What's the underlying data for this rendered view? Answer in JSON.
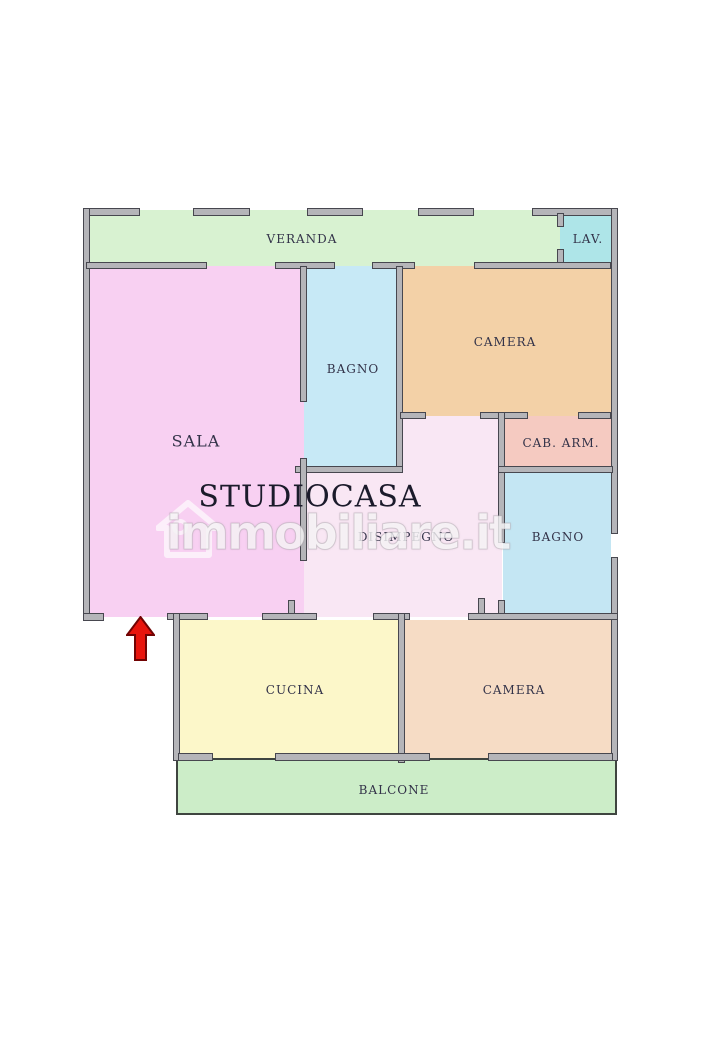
{
  "meta": {
    "width": 717,
    "height": 1050,
    "background": "#ffffff"
  },
  "palette": {
    "wall_fill": "#b5b5b9",
    "wall_border": "#47474f",
    "label_color": "#333349"
  },
  "brand_title": "STUDIOCASA",
  "watermark": {
    "text": "immobiliare.it",
    "icon": "house-icon"
  },
  "entrance_arrow": {
    "direction": "up",
    "fill": "#e8150d",
    "stroke": "#710303"
  },
  "rooms": [
    {
      "id": "veranda",
      "label": "VERANDA",
      "color": "#d8f2d1",
      "rect": [
        86,
        210,
        527,
        56
      ],
      "label_at": [
        302,
        239
      ],
      "font": 12
    },
    {
      "id": "lav",
      "label": "LAV.",
      "color": "#aee5e8",
      "rect": [
        560,
        210,
        53,
        56
      ],
      "label_at": [
        588,
        239
      ],
      "font": 12
    },
    {
      "id": "sala",
      "label": "SALA",
      "color": "#f8d0f2",
      "rect": [
        86,
        266,
        218,
        351
      ],
      "label_at": [
        196,
        441
      ],
      "font": 16
    },
    {
      "id": "disimpegno",
      "label": "DISIMPEGNO",
      "color": "#f9e7f4",
      "rect": [
        304,
        416,
        198,
        201
      ],
      "label_at": [
        406,
        537
      ],
      "font": 12
    },
    {
      "id": "bagno-1",
      "label": "BAGNO",
      "color": "#c7e9f6",
      "rect": [
        304,
        266,
        96,
        207
      ],
      "label_at": [
        353,
        369
      ],
      "font": 12
    },
    {
      "id": "camera-1",
      "label": "CAMERA",
      "color": "#f3d1a7",
      "rect": [
        400,
        266,
        213,
        150
      ],
      "label_at": [
        505,
        342
      ],
      "font": 12
    },
    {
      "id": "cab-arm",
      "label": "CAB. ARM.",
      "color": "#f5cac1",
      "rect": [
        503,
        416,
        110,
        57
      ],
      "label_at": [
        561,
        443
      ],
      "font": 12
    },
    {
      "id": "bagno-2",
      "label": "BAGNO",
      "color": "#c4e6f3",
      "rect": [
        503,
        473,
        108,
        144
      ],
      "label_at": [
        558,
        537
      ],
      "font": 12
    },
    {
      "id": "cucina",
      "label": "CUCINA",
      "color": "#fcf7c9",
      "rect": [
        178,
        620,
        222,
        140
      ],
      "label_at": [
        295,
        690
      ],
      "font": 12
    },
    {
      "id": "camera-2",
      "label": "CAMERA",
      "color": "#f6dcc5",
      "rect": [
        403,
        620,
        210,
        140
      ],
      "label_at": [
        514,
        690
      ],
      "font": 12
    },
    {
      "id": "balcone",
      "label": "BALCONE",
      "color": "#ccedc8",
      "rect": [
        176,
        758,
        441,
        57
      ],
      "label_at": [
        394,
        790
      ],
      "font": 12,
      "outlined": true
    }
  ],
  "walls": [
    [
      83,
      208,
      57,
      8
    ],
    [
      193,
      208,
      57,
      8
    ],
    [
      307,
      208,
      56,
      8
    ],
    [
      418,
      208,
      56,
      8
    ],
    [
      532,
      208,
      86,
      8
    ],
    [
      83,
      208,
      7,
      413
    ],
    [
      83,
      613,
      21,
      8
    ],
    [
      611,
      208,
      7,
      326
    ],
    [
      611,
      557,
      7,
      204
    ],
    [
      86,
      262,
      121,
      7
    ],
    [
      275,
      262,
      60,
      7
    ],
    [
      372,
      262,
      43,
      7
    ],
    [
      474,
      262,
      137,
      7
    ],
    [
      557,
      213,
      7,
      14
    ],
    [
      557,
      249,
      7,
      14
    ],
    [
      300,
      266,
      7,
      136
    ],
    [
      396,
      266,
      7,
      207
    ],
    [
      295,
      466,
      108,
      7
    ],
    [
      300,
      458,
      7,
      103
    ],
    [
      400,
      412,
      26,
      7
    ],
    [
      480,
      412,
      48,
      7
    ],
    [
      578,
      412,
      33,
      7
    ],
    [
      498,
      412,
      7,
      131
    ],
    [
      498,
      466,
      115,
      7
    ],
    [
      498,
      600,
      7,
      16
    ],
    [
      167,
      613,
      41,
      7
    ],
    [
      262,
      613,
      55,
      7
    ],
    [
      373,
      613,
      37,
      7
    ],
    [
      468,
      613,
      150,
      7
    ],
    [
      288,
      600,
      7,
      14
    ],
    [
      478,
      598,
      7,
      16
    ],
    [
      173,
      613,
      7,
      148
    ],
    [
      398,
      613,
      7,
      150
    ],
    [
      178,
      753,
      35,
      8
    ],
    [
      275,
      753,
      155,
      8
    ],
    [
      488,
      753,
      125,
      8
    ]
  ]
}
